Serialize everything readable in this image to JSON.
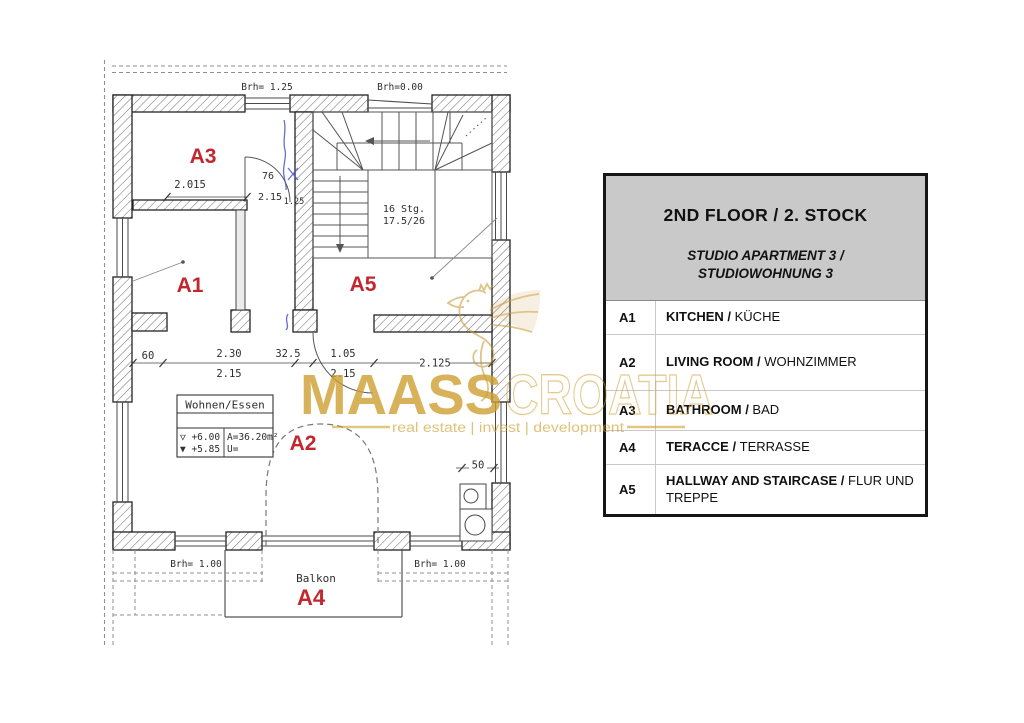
{
  "plan": {
    "rooms": {
      "a1": "A1",
      "a2": "A2",
      "a3": "A3",
      "a4": "A4",
      "a5": "A5"
    },
    "texts": {
      "brh_top_left": "Brh= 1.25",
      "brh_top_right": "Brh=0.00",
      "brh_bottom_left": "Brh= 1.00",
      "brh_bottom_right": "Brh= 1.00",
      "stair_line1": "16 Stg.",
      "stair_line2": "17.5/26",
      "dim_a3": "2.015",
      "door_width": "76",
      "door_height": "2.15",
      "door_sub": "1.25",
      "dim_60": "60",
      "dim_230": "2.30",
      "dim_325": "32.5",
      "dim_105": "1.05",
      "dim_2125": "2.125",
      "dim_215_left": "2.15",
      "dim_215_right": "2.15",
      "dim_50": "50",
      "balkon": "Balkon"
    },
    "info_box": {
      "title": "Wohnen/Essen",
      "level_upper": "▽ +6.00",
      "level_lower": "▼ +5.85",
      "area": "A=36.20m²",
      "u_value": "U="
    }
  },
  "legend": {
    "title": "2ND FLOOR / 2. STOCK",
    "subtitle_line1": "STUDIO APARTMENT 3 /",
    "subtitle_line2": "STUDIOWOHNUNG 3",
    "rows": [
      {
        "code": "A1",
        "name_bold": "KITCHEN / ",
        "name_reg": "KÜCHE"
      },
      {
        "code": "A2",
        "name_bold": "LIVING ROOM / ",
        "name_reg": "WOHNZIMMER"
      },
      {
        "code": "A3",
        "name_bold": "BATHROOM / ",
        "name_reg": "BAD"
      },
      {
        "code": "A4",
        "name_bold": "TERACCE / ",
        "name_reg": "TERRASSE"
      },
      {
        "code": "A5",
        "name_bold": "HALLWAY AND STAIRCASE / ",
        "name_reg": "FLUR UND TREPPE"
      }
    ]
  },
  "watermark": {
    "brand_primary": "MAASS",
    "brand_secondary": "CROATIA",
    "tagline": "real estate | invest | development"
  },
  "colors": {
    "room_label_red": "#c1272d",
    "watermark_gold": "#cfa032",
    "wall_outline": "#222222",
    "drawing_line": "#555555",
    "legend_header_gray": "#c9c9c9"
  }
}
